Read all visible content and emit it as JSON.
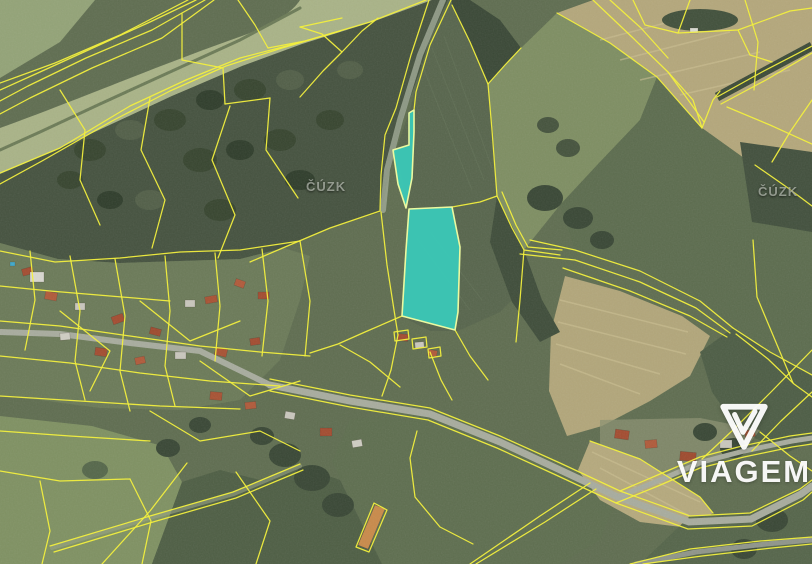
{
  "map": {
    "watermarks": [
      {
        "text": "ČÚZK"
      },
      {
        "text": "ČÚZK"
      }
    ],
    "brand": {
      "name": "VIAGEM"
    },
    "highlighted_parcels": 2,
    "colors": {
      "parcel_line": "#f2ef3e",
      "highlight_fill": "#38cdbd",
      "highlight_stroke": "#ebf9a0"
    }
  }
}
